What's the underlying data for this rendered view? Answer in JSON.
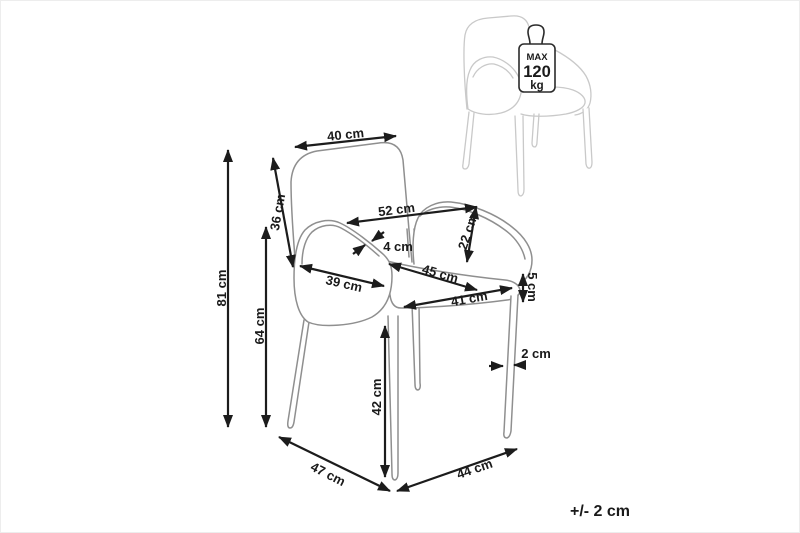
{
  "diagram": {
    "type": "chair-dimension-diagram",
    "tolerance_note": "+/- 2 cm",
    "weight_limit": {
      "icon": "max-weight-icon",
      "prefix": "MAX",
      "value": "120",
      "unit": "kg"
    },
    "dimensions": {
      "backrest_top_width": "40 cm",
      "backrest_height": "36 cm",
      "total_height": "81 cm",
      "armrest_height": "64 cm",
      "total_width": "52 cm",
      "armrest_above_seat": "22 cm",
      "armrest_thickness": "4 cm",
      "armrest_length": "39 cm",
      "seat_depth": "45 cm",
      "seat_width": "41 cm",
      "seat_edge_thickness": "5 cm",
      "seat_height": "42 cm",
      "leg_thickness": "2 cm",
      "base_depth": "47 cm",
      "base_width": "44 cm"
    },
    "colors": {
      "background": "#ffffff",
      "annotation": "#1c1c1c",
      "chair_outline": "#8f8f8f",
      "reference_chair_outline": "#c9c9c9",
      "badge_outline": "#2b2b2b"
    }
  }
}
